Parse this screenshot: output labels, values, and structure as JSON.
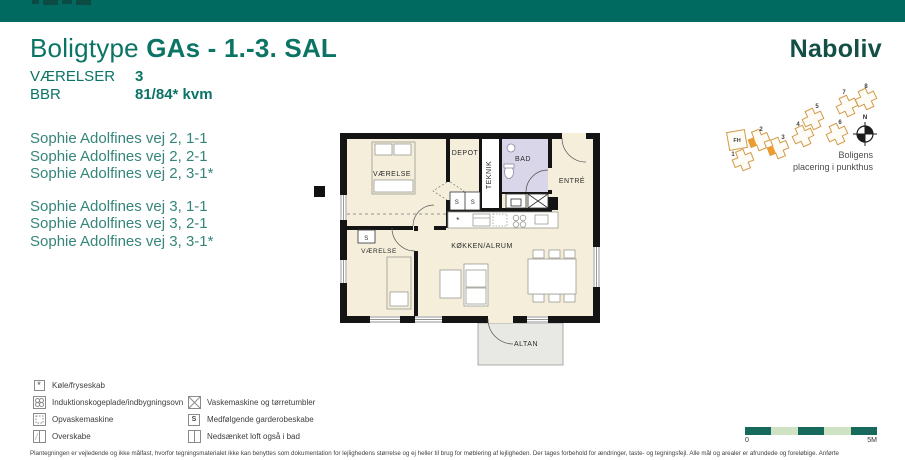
{
  "top_bar": {
    "color": "#006a60"
  },
  "title": {
    "prefix": "Boligtype",
    "name": "GAs - 1.-3. SAL"
  },
  "specs": {
    "rows": [
      {
        "label": "VÆRELSER",
        "value": "3"
      },
      {
        "label": "BBR",
        "value": "81/84* kvm"
      }
    ]
  },
  "addresses": {
    "group1": [
      "Sophie Adolfines vej 2, 1-1",
      "Sophie Adolfines vej 2, 2-1",
      "Sophie Adolfines vej 2, 3-1*"
    ],
    "group2": [
      "Sophie Adolfines vej 3, 1-1",
      "Sophie Adolfines vej 3, 2-1",
      "Sophie Adolfines vej 3, 3-1*"
    ]
  },
  "logo": {
    "text": "Naboliv"
  },
  "site_plan": {
    "caption": {
      "line1": "Boligens",
      "line2": "placering i punkthus"
    },
    "compass_label": "N",
    "fh_label": "FH",
    "numbers": [
      "1",
      "2",
      "3",
      "4",
      "5",
      "6",
      "7",
      "8"
    ],
    "colors": {
      "outline": "#d29a45",
      "highlight": "#ef9b2d"
    }
  },
  "floor_plan": {
    "labels": {
      "vaerelse_top": "VÆRELSE",
      "depot": "DEPOT",
      "teknik": "TEKNIK",
      "bad": "BAD",
      "entre": "ENTRÉ",
      "vaerelse_bottom": "VÆRELSE",
      "koekken": "KØKKEN/ALRUM",
      "altan": "ALTAN",
      "closet": "S",
      "fridge_symbol": "*"
    },
    "colors": {
      "floor": "#f4eedb",
      "bath": "#d9d6e9",
      "balcony": "#e8e8e4",
      "wall": "#141414"
    }
  },
  "legend": {
    "left": [
      {
        "icon": "asterisk-box",
        "symbol": "*",
        "label": "Køle/fryseskab"
      },
      {
        "icon": "induction-hob",
        "label": "Induktionskogeplade/indbygningsovn"
      },
      {
        "icon": "dishwasher",
        "label": "Opvaskemaskine"
      },
      {
        "icon": "wall-cabinet",
        "label": "Overskabe"
      }
    ],
    "right": [
      {
        "icon": "washer-dryer",
        "label": "Vaskemaskine og tørretumbler"
      },
      {
        "icon": "wardrobe-s",
        "symbol": "S",
        "label": "Medfølgende garderobeskabe"
      },
      {
        "icon": "lowered-ceiling",
        "label": "Nedsænket loft også i bad"
      }
    ]
  },
  "scale_bar": {
    "start": "0",
    "end": "5M",
    "dark_color": "#17695c",
    "light_color": "#cfe2c3"
  },
  "disclaimer": "Plantegningen er vejledende og ikke målfast, hvorfor tegningsmaterialet ikke kan benyttes som dokumentation for lejlighedens størrelse og ej heller til brug for møblering af lejligheden. Der tages forbehold for ændringer, taste- og tegningsfejl. Alle mål og arealer er afrundede og foreløbige. Anførte"
}
